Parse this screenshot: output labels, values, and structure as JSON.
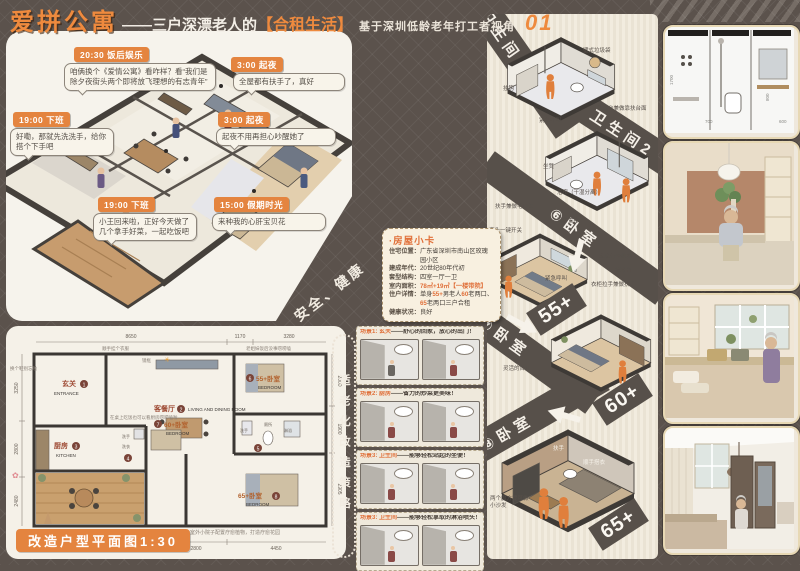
{
  "title": {
    "main": "爱拼公寓",
    "dash": "——三户深漂老人的",
    "highlight": "【合租生活】",
    "subtitle": "基于深圳低龄老年打工者视角",
    "page_no": "01"
  },
  "iso": {
    "bubbles": [
      {
        "time": "20:30",
        "tag": "饭后娱乐",
        "text": "咱俩换个《爱情公寓》看咋样？看“我们是除夕夜街头两个即将放飞理想的有志青年”"
      },
      {
        "time": "3:00",
        "tag": "起夜",
        "text": "全屋都有扶手了，真好"
      },
      {
        "time": "19:00",
        "tag": "下班",
        "text": "好嘞，那就先洗洗手，给你搭个下手吧"
      },
      {
        "time": "3:00",
        "tag": "起夜",
        "text": "起夜不用再担心吵醒她了"
      },
      {
        "time": "19:00",
        "tag": "下班",
        "text": "小王回来啦，正好今天做了几个拿手好菜，一起吃饭吧"
      },
      {
        "time": "15:00",
        "tag": "假期时光",
        "text": "来种我的心肝宝贝花"
      }
    ]
  },
  "banners": {
    "safety": "安全、健康",
    "strategy": "适老化改造策略"
  },
  "house_card": {
    "title": "·房屋小卡",
    "loc_label": "住宅位置：",
    "loc": "广东省深圳市南山区玫瑰园小区",
    "year_label": "建成年代：",
    "year": "20世纪80年代初",
    "type_label": "套型结构：",
    "type": "四室一厅一卫",
    "area_label": "室内面积：",
    "area": "78㎡+19㎡【一楼带院】",
    "occ_label": "住户详情：",
    "occ_p1": "单身",
    "occ_h1": "55+",
    "occ_p2": "男老人",
    "occ_h2": "60",
    "occ_p3": "老两口、",
    "occ_h3": "65",
    "occ_p4": "老两口",
    "occ_p5": "三户合租",
    "health_label": "健康状况：",
    "health": "良好"
  },
  "plan": {
    "caption": "改造户型平面图1:30",
    "rooms": {
      "entrance_cn": "玄关",
      "entrance_num": "1",
      "entrance_en": "ENTRANCE",
      "living_cn": "客餐厅",
      "living_num": "2",
      "living_en": "LIVING AND DINING ROOM",
      "kitchen_cn": "厨房",
      "kitchen_num": "3",
      "kitchen_en": "KITCHEN",
      "util_num": "4",
      "util_a": "洗手",
      "util_b": "洗衣",
      "bath_num": "5",
      "bath_a": "洗手",
      "bath_b": "厕所",
      "bath_c": "淋浴",
      "bed6_num": "6",
      "bed6_cn": "55+卧室",
      "bed6_en": "BEDROOM",
      "bed7_num": "7",
      "bed7_cn": "60+卧室",
      "bed7_en": "BEDROOM",
      "bed8_num": "8",
      "bed8_cn": "65+卧室",
      "bed8_en": "BEDROOM"
    },
    "dims_top": [
      "8650",
      "1170",
      "3280"
    ],
    "dims_left": [
      "3250",
      "2800",
      "2480"
    ],
    "dims_right": [
      "2000",
      "1900",
      "2905"
    ],
    "dims_bottom": [
      "2050",
      "1500",
      "800",
      "700",
      "800",
      "2800",
      "4450"
    ],
    "notes": [
      "顺手挂个衣服",
      "换个鞋别忘啦",
      "镜框",
      "老姐妹饭后没事唠唠嗑",
      "在桌上吃饭也可以看厨房唠唠嗑啦",
      "室外小院子配置疗愈植物，打造疗愈花园"
    ]
  },
  "scenes": [
    {
      "tag": "场景1: 玄关",
      "desc": "——舒心的回家，放心的出门！"
    },
    {
      "tag": "场景2: 厨房",
      "desc": "——省力的炒菜更美味！"
    },
    {
      "tag": "场景3: 卫生间",
      "desc": "——能够轻松站起的坐便！"
    },
    {
      "tag": "场景3: 卫生间",
      "desc": "——能够轻松拿取的淋浴喷头！"
    }
  ],
  "right_col": {
    "bath1_label": "卫生间1",
    "bath2_label": "卫生间2",
    "bed6_label": "⑥卧室",
    "bed7_label": "⑦卧室",
    "bed8_label": "⑧卧室",
    "age_55": "55+",
    "age_60": "60+",
    "age_65": "65+",
    "bath1_notes": [
      "挂钩",
      "壁式垃圾袋",
      "紧急呼叫",
      "洗漱台兼做靠扶台面"
    ],
    "bath2_notes": [
      "坐凳",
      "浴帘（干湿分离）",
      "扶手兼做毛巾架"
    ],
    "bed6_notes": [
      "床头一键开关",
      "窗台置物",
      "紧急呼叫"
    ],
    "bed7_notes": [
      "床底行李收纳",
      "梳妆台",
      "衣柜拉手兼做扶手",
      "灵活的台灯"
    ],
    "bed8_notes": [
      "扶手",
      "顺手搭衣",
      "两个魔方凳可做小沙发"
    ]
  },
  "photos": {
    "p1_dims": [
      "1700",
      "450",
      "700",
      "800",
      "750",
      "600",
      "550"
    ]
  }
}
